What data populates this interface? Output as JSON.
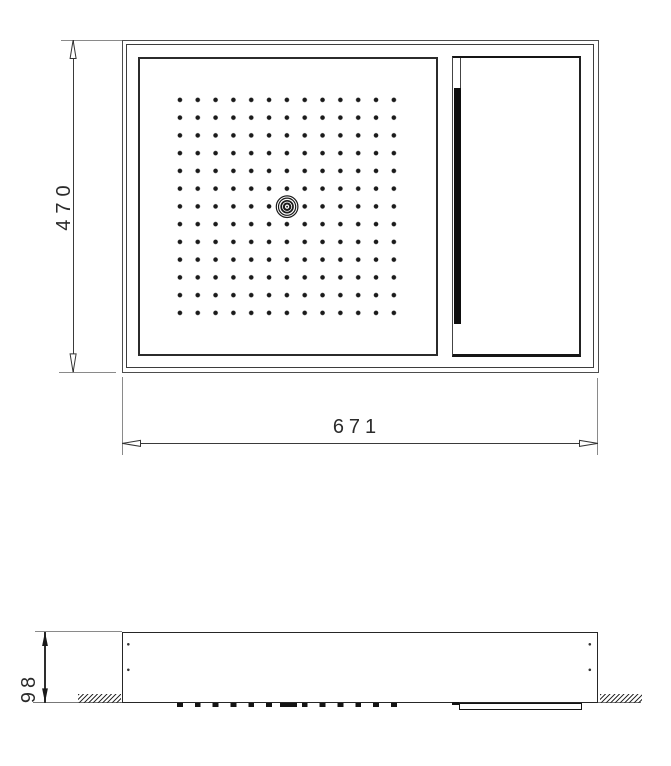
{
  "document": {
    "type": "technical drawing",
    "subject": "ceiling shower head installation drawing",
    "views": {
      "top": "top view (plan)",
      "side": "side view (section at ceiling)"
    }
  },
  "dims": {
    "top_height": "470",
    "top_width": "671",
    "side_depth": "98"
  },
  "grid": {
    "rows": 13,
    "cols": 13,
    "element": "spray nozzle"
  },
  "features": {
    "center_element": "concentric-ring nozzle at grid center",
    "right_panel": "rectangular panel with black slot bar",
    "hatching": "ceiling cut hatch left and right of housing"
  },
  "colors": {
    "line": "#333333",
    "line_dark": "#141414",
    "line_light": "#8a8a8a",
    "background": "#ffffff"
  }
}
